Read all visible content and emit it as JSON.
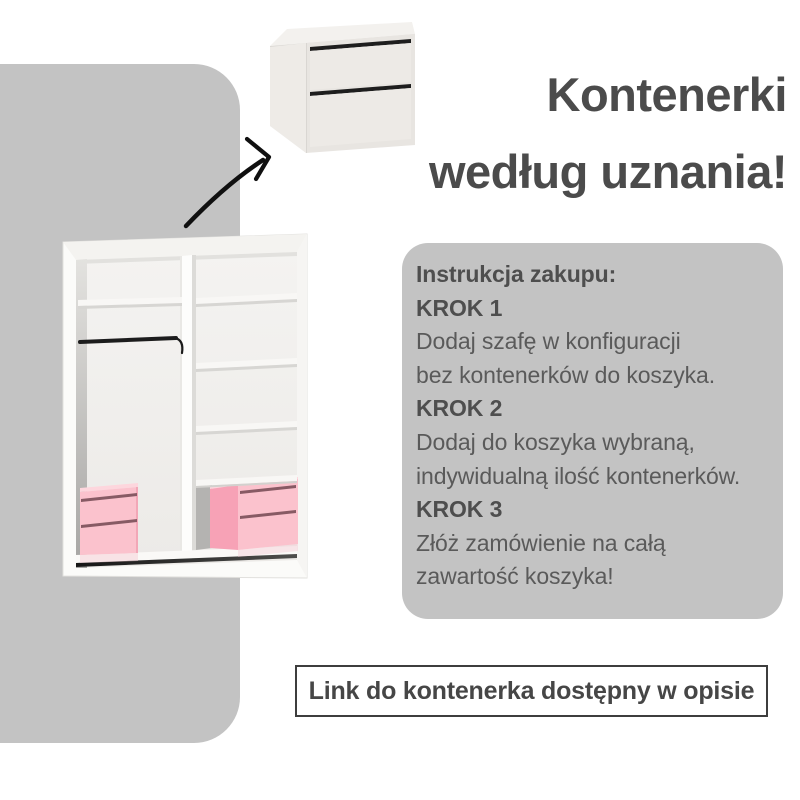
{
  "title": {
    "line1": "Kontenerki",
    "line2": "według uznania!"
  },
  "instructions": {
    "heading": "Instrukcja zakupu:",
    "steps": [
      {
        "label": "KROK 1",
        "line1": "Dodaj szafę w konfiguracji",
        "line2": "bez kontenerków do koszyka."
      },
      {
        "label": "KROK 2",
        "line1": "Dodaj do koszyka wybraną,",
        "line2": "indywidualną ilość kontenerków."
      },
      {
        "label": "KROK 3",
        "line1": "Złóż zamówienie na całą",
        "line2": "zawartość koszyka!"
      }
    ]
  },
  "footer": {
    "note": "Link do kontenerka dostępny w opisie"
  },
  "illustrations": {
    "container_unit": "container-with-two-drawers",
    "wardrobe": "wardrobe-interior-with-two-pink-containers",
    "arrow": "curved-arrow-to-container"
  },
  "colors": {
    "panel_gray": "#c3c3c3",
    "title_text": "#4b4b4b",
    "body_text": "#5a5a5a",
    "bold_text": "#4e4e4e",
    "note_border": "#3e3e3e",
    "container_pink_front": "#fbc2cd",
    "container_pink_side": "#f7a2b6",
    "container_pink_top": "#fdd6dd",
    "container_handle": "#875a64",
    "arrow_black": "#101010"
  }
}
